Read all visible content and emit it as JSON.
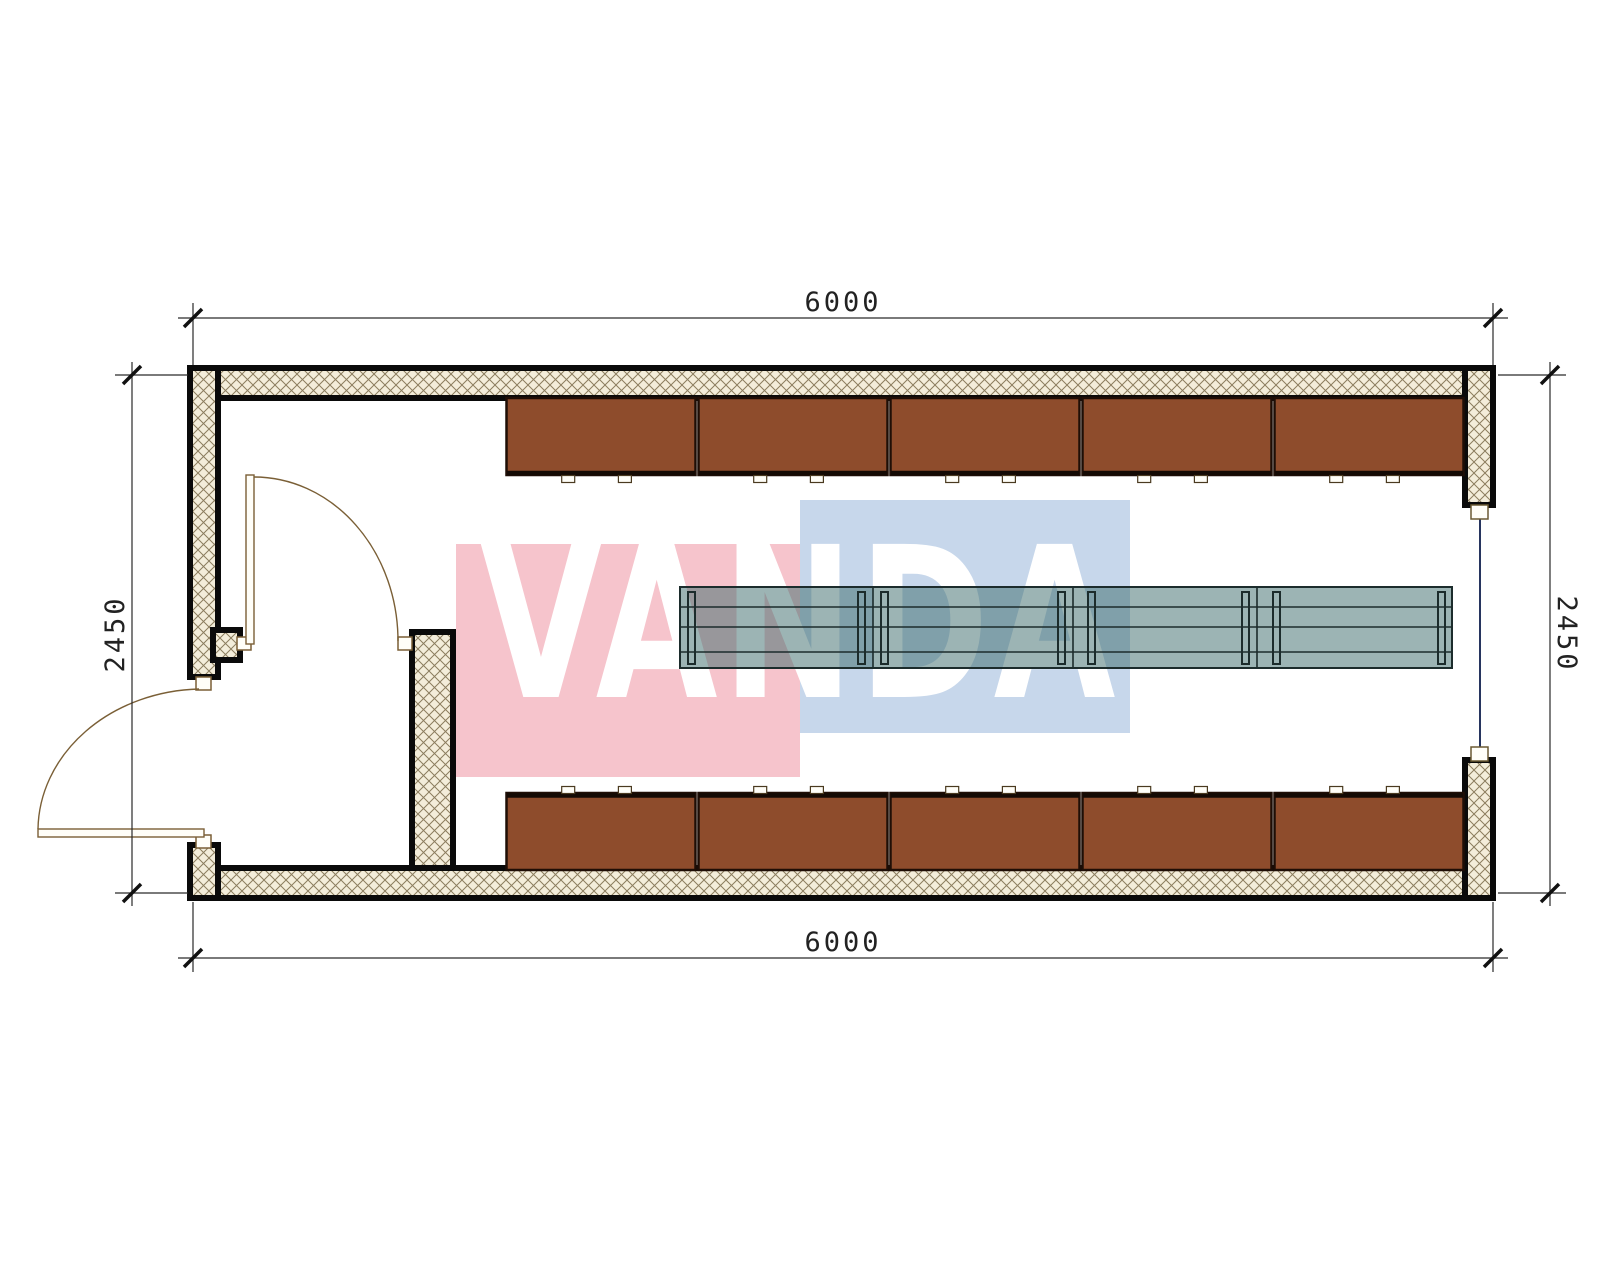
{
  "plan": {
    "watermark": {
      "text": "VANDA",
      "red_block_color": "#f6c4cc",
      "blue_block_color": "#c7d7eb"
    },
    "dimensions": {
      "top": "6000",
      "bottom": "6000",
      "left": "2450",
      "right": "2450"
    },
    "colors": {
      "cabinet_fill": "#8e4c2c",
      "cabinet_border": "#1f0e06",
      "cabinet_edge": "#140a04",
      "table_fill": "rgba(58,105,105,0.5)",
      "table_line": "#1c2c2c",
      "wall_hatch_bg": "#f3edda",
      "wall_hatch_line": "#8b7d5e",
      "wall_outline": "#0a0a0a",
      "window_glass": "#27355f",
      "door_line": "#7a5f36",
      "frame_fill": "#fffef8",
      "dim_line": "#2a2a2a",
      "dim_text": "#222222"
    },
    "furniture": {
      "top_cabinet_count": 5,
      "bottom_cabinet_count": 5,
      "table_segment_count": 4
    }
  }
}
